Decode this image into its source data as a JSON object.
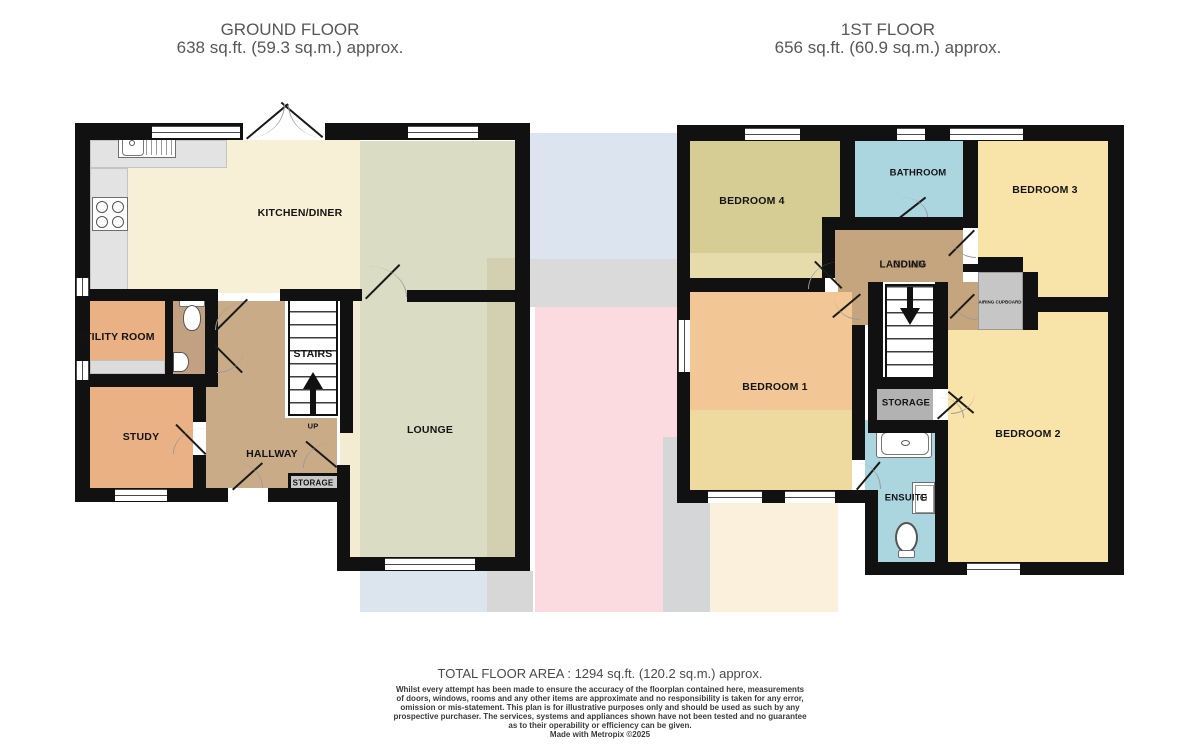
{
  "header": {
    "ground": {
      "title": "GROUND FLOOR",
      "area": "638 sq.ft. (59.3 sq.m.) approx."
    },
    "first": {
      "title": "1ST FLOOR",
      "area": "656 sq.ft. (60.9 sq.m.) approx."
    }
  },
  "ground": {
    "labels": {
      "kitchen": "KITCHEN/DINER",
      "utility": "UTILITY ROOM",
      "study": "STUDY",
      "stairs": "STAIRS",
      "up": "UP",
      "hallway": "HALLWAY",
      "storage": "STORAGE",
      "lounge": "LOUNGE"
    }
  },
  "first": {
    "labels": {
      "bedroom4": "BEDROOM 4",
      "bathroom": "BATHROOM",
      "bedroom3": "BEDROOM 3",
      "landing": "LANDING",
      "down": "DOWN",
      "airing": "AIRING CUPBOARD",
      "bedroom1": "BEDROOM 1",
      "storage": "STORAGE",
      "bedroom2": "BEDROOM 2",
      "ensuite": "ENSUITE"
    }
  },
  "footer": {
    "total": "TOTAL FLOOR AREA : 1294 sq.ft. (120.2 sq.m.) approx.",
    "disclaimer_lines": [
      "Whilst every attempt has been made to ensure the accuracy of the floorplan contained here, measurements",
      "of doors, windows, rooms and any other items are approximate and no responsibility is taken for any error,",
      "omission or mis-statement. This plan is for illustrative purposes only and should be used as such by any",
      "prospective purchaser. The services, systems and appliances shown have not been tested and no guarantee",
      "as to their operability or efficiency can be given."
    ],
    "credit": "Made with Metropix ©2025"
  },
  "colors": {
    "wall": "#111111",
    "kitchen_cream": "#f8f0d6",
    "lounge_green": "#dadcc4",
    "hallway_tan": "#c9ab88",
    "landing_tan": "#c5a57e",
    "utility_orange": "#eab185",
    "wc_brown": "#c2a183",
    "bedroom_khaki": "#d5cd94",
    "bedroom_yellow": "#f8e3a8",
    "bedroom_peach": "#f2c795",
    "bath_blue": "#abd5df",
    "storage_gray": "#b2b2b2",
    "counter_gray": "#e3e3e3",
    "bg_blue": "#dbe4ef",
    "bg_pink": "#fbdbdf",
    "bg_gray": "#d9dad9",
    "bg_cream": "#faf0db",
    "title_gray": "#575757"
  }
}
